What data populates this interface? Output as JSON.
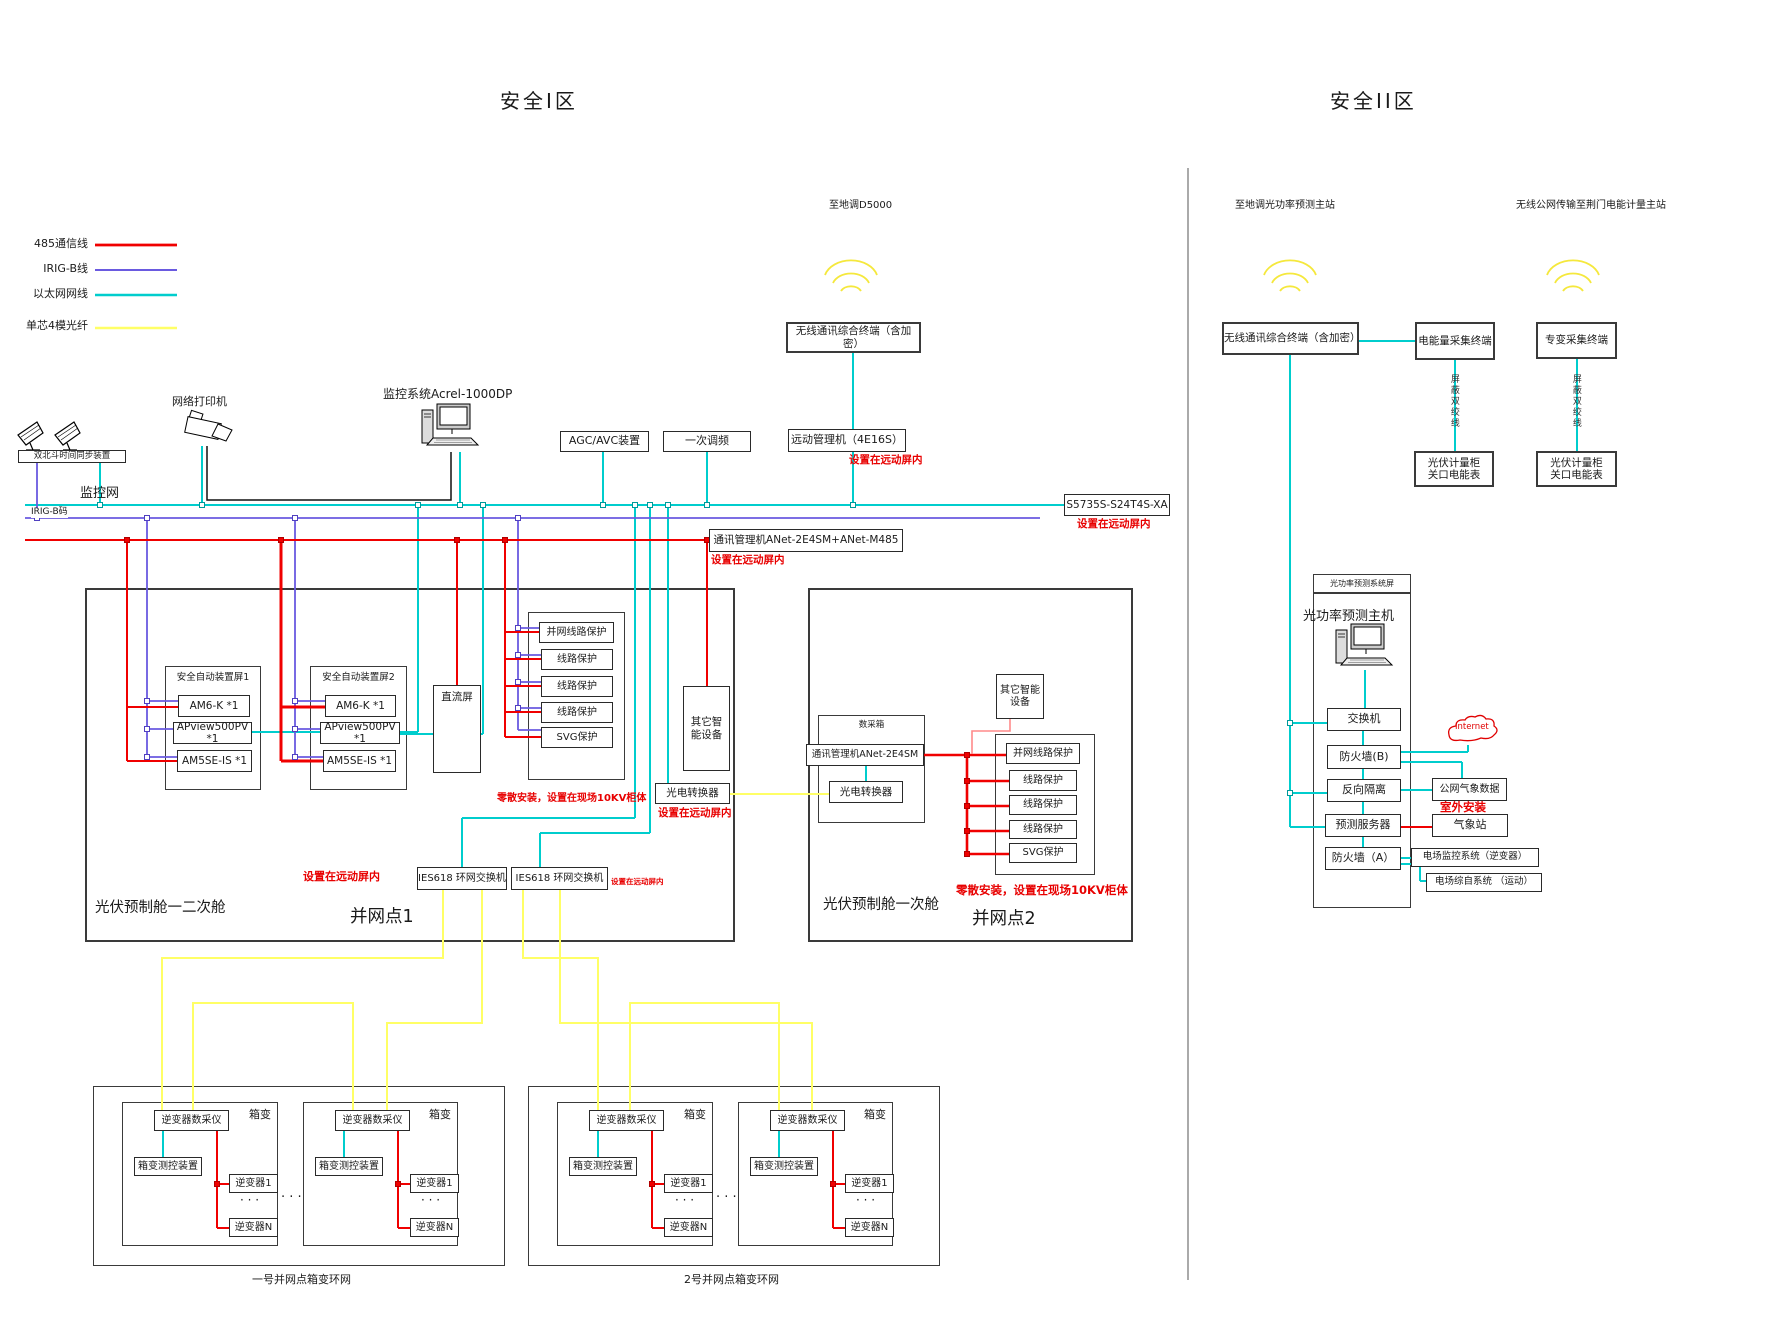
{
  "zone1": {
    "title": "安全I区",
    "legend": [
      {
        "label": "485通信线",
        "color": "#f00000"
      },
      {
        "label": "IRIG-B线",
        "color": "#6a5ae0"
      },
      {
        "label": "以太网网线",
        "color": "#00cdcd"
      },
      {
        "label": "单芯4模光纤",
        "color": "#ffff66"
      }
    ],
    "beidou": "双北斗时间同步装置",
    "printer": "网络打印机",
    "scada": "监控系统Acrel-1000DP",
    "monitor_net": "监控网",
    "irig_code": "IRIG-B码",
    "agc": "AGC/AVC装置",
    "freq": "一次调频",
    "rtu": "远动管理机（4E16S）",
    "to_dispatch": "至地调D5000",
    "wireless_term": "无线通讯综合终端（含加密）",
    "switch": "S5735S-S24T4S-XA",
    "comm_mgr": "通讯管理机ANet-2E4SM+ANet-M485",
    "note_remote": "设置在远动屏内",
    "note_scatter": "零散安装，设置在现场10KV柜体",
    "grid1": {
      "panel1": "安全自动装置屏1",
      "panel2": "安全自动装置屏2",
      "am6k": "AM6-K *1",
      "apview": "APview500PV *1",
      "am5se": "AM5SE-IS *1",
      "dc": "直流屏",
      "prot": [
        "并网线路保护",
        "线路保护",
        "线路保护",
        "线路保护",
        "SVG保护"
      ],
      "other": "其它智能设备",
      "converter": "光电转换器",
      "ies": "IES618 环网交换机",
      "cabin": "光伏预制舱一二次舱",
      "point": "并网点1"
    },
    "grid2": {
      "daq_box": "数采箱",
      "comm": "通讯管理机ANet-2E4SM",
      "converter": "光电转换器",
      "other": "其它智能设备",
      "prot": [
        "并网线路保护",
        "线路保护",
        "线路保护",
        "线路保护",
        "SVG保护"
      ],
      "cabin": "光伏预制舱一次舱",
      "point": "并网点2"
    },
    "ring": {
      "xiangbian": "箱变",
      "daq": "逆变器数采仪",
      "ctrl": "箱变测控装置",
      "inv1": "逆变器1",
      "invN": "逆变器N",
      "dots": "· · ·",
      "cap1": "一号并网点箱变环网",
      "cap2": "2号并网点箱变环网"
    }
  },
  "zone2": {
    "title": "安全II区",
    "to_pred": "至地调光功率预测主站",
    "to_jingmen": "无线公网传输至荆门电能计量主站",
    "wireless_term": "无线通讯综合终端（含加密）",
    "energy_term": "电能量采集终端",
    "tr_term": "专变采集终端",
    "twisted": "屏蔽双绞线",
    "meter": {
      "l1": "光伏计量柜",
      "l2": "关口电能表"
    },
    "pred_panel": "光功率预测系统屏",
    "pred_host": "光功率预测主机",
    "switch": "交换机",
    "fw_b": "防火墙(B)",
    "internet": "Internet",
    "reverse": "反向隔离",
    "weather_data": "公网气象数据",
    "outdoor": "室外安装",
    "pred_server": "预测服务器",
    "weather_station": "气象站",
    "fw_a": "防火墙（A）",
    "field_scada": "电场监控系统（逆变器）",
    "field_auto": "电场综自系统 （运动）"
  }
}
